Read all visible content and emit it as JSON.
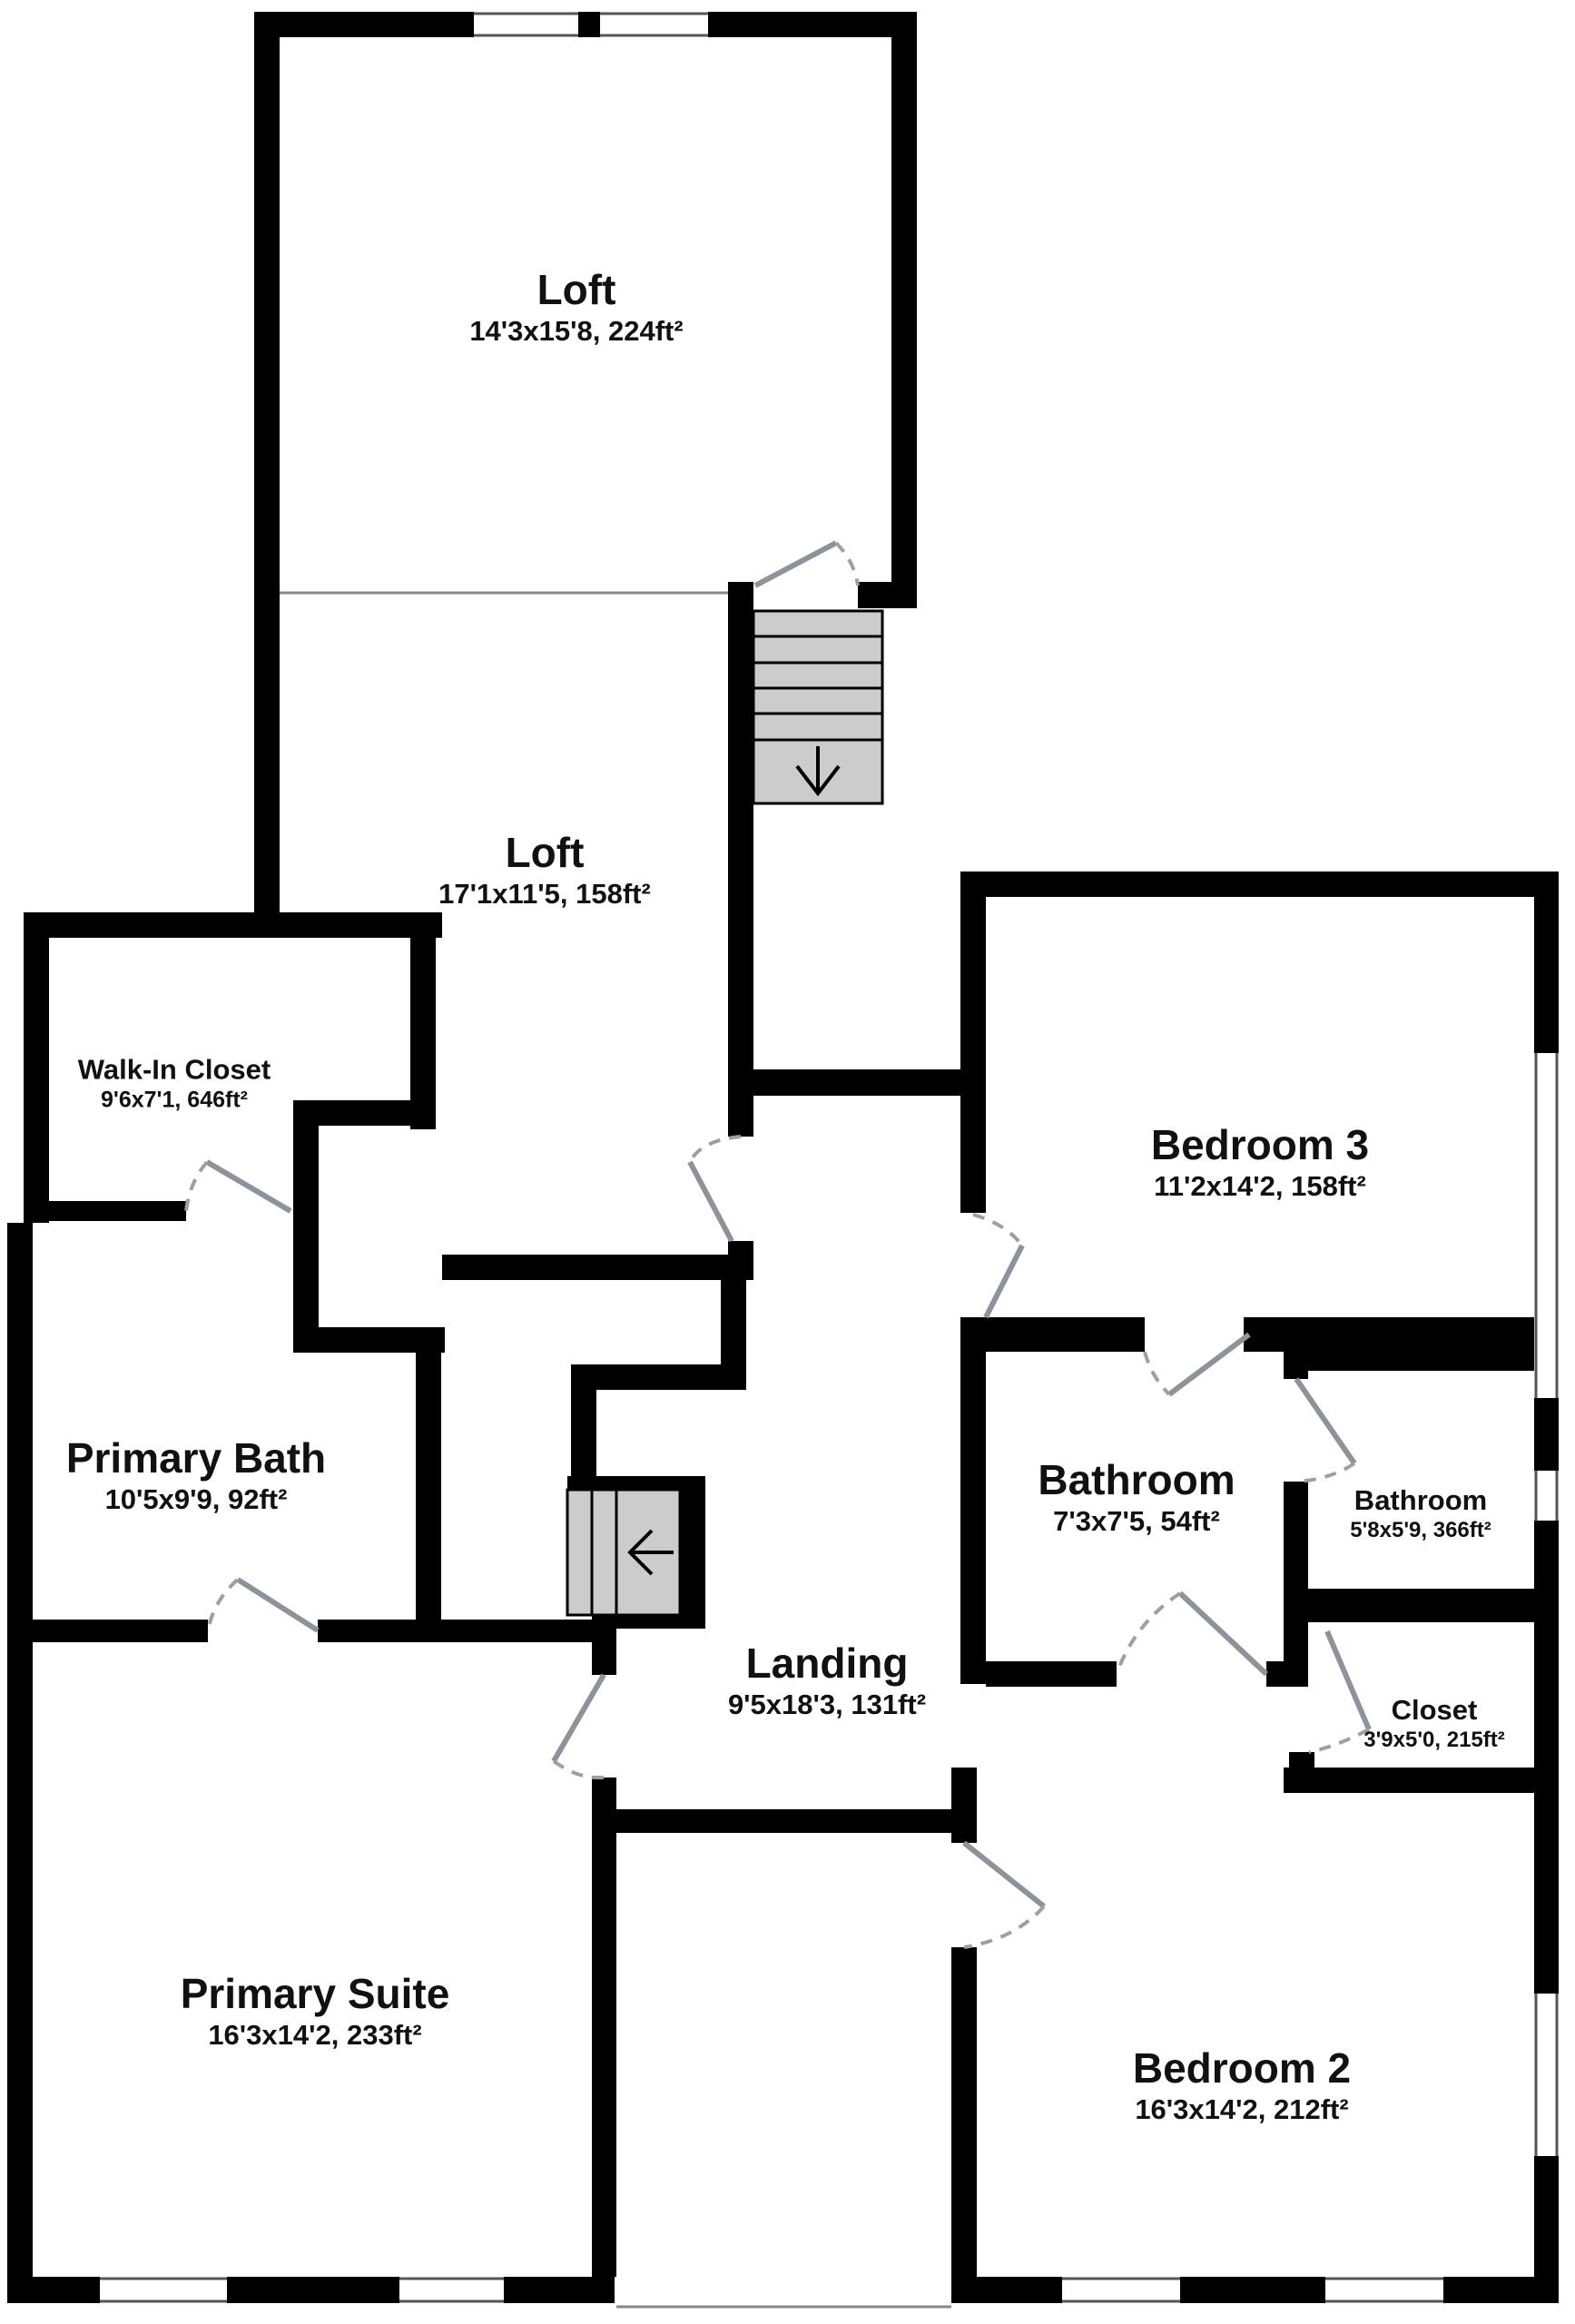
{
  "floorplan": {
    "title": "Upper floor plan",
    "rooms": [
      {
        "id": "loft-upper",
        "name": "Loft",
        "dims": "14'3x15'8, 224ft²"
      },
      {
        "id": "loft-lower",
        "name": "Loft",
        "dims": "17'1x11'5, 158ft²"
      },
      {
        "id": "walk-in-closet",
        "name": "Walk-In Closet",
        "dims": "9'6x7'1, 646ft²"
      },
      {
        "id": "bedroom-3",
        "name": "Bedroom 3",
        "dims": "11'2x14'2, 158ft²"
      },
      {
        "id": "primary-bath",
        "name": "Primary Bath",
        "dims": "10'5x9'9, 92ft²"
      },
      {
        "id": "bathroom",
        "name": "Bathroom",
        "dims": "7'3x7'5, 54ft²"
      },
      {
        "id": "bathroom-2",
        "name": "Bathroom",
        "dims": "5'8x5'9, 366ft²"
      },
      {
        "id": "landing",
        "name": "Landing",
        "dims": "9'5x18'3, 131ft²"
      },
      {
        "id": "closet",
        "name": "Closet",
        "dims": "3'9x5'0, 215ft²"
      },
      {
        "id": "primary-suite",
        "name": "Primary Suite",
        "dims": "16'3x14'2, 233ft²"
      },
      {
        "id": "bedroom-2",
        "name": "Bedroom 2",
        "dims": "16'3x14'2, 212ft²"
      }
    ],
    "stairs": [
      {
        "id": "stairs-down",
        "arrow": "down"
      },
      {
        "id": "stairs-left",
        "arrow": "left"
      }
    ],
    "colors": {
      "wall": "#000000",
      "stair_fill": "#cccccc",
      "door": "#8d939a",
      "thin_line": "#666666"
    }
  }
}
